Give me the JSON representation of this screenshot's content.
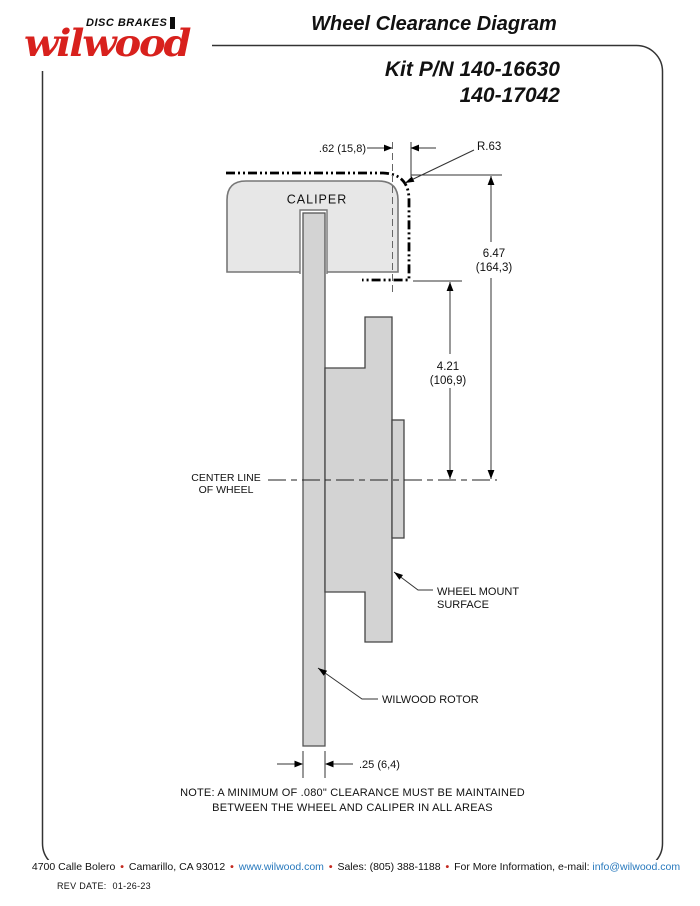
{
  "colors": {
    "brand_red": "#d8211d",
    "link_blue": "#2879bd",
    "caliper_fill": "#e7e7e7",
    "rotor_fill": "#d3d3d3",
    "line_dark": "#333333"
  },
  "logo": {
    "brand": "wilwood",
    "tagline": "DISC BRAKES"
  },
  "header": {
    "title": "Wheel Clearance Diagram",
    "kit_line1": "Kit P/N 140-16630",
    "kit_line2": "140-17042"
  },
  "diagram": {
    "caliper_label": "CALIPER",
    "dim_caliper_overhang": ".62 (15,8)",
    "corner_radius_label": "R.63",
    "dim_caliper_height_in": "6.47",
    "dim_caliper_height_mm": "(164,3)",
    "dim_mount_to_center_in": "4.21",
    "dim_mount_to_center_mm": "(106,9)",
    "centerline_line1": "CENTER LINE",
    "centerline_line2": "OF WHEEL",
    "wheel_mount_line1": "WHEEL MOUNT",
    "wheel_mount_line2": "SURFACE",
    "rotor_label": "WILWOOD ROTOR",
    "dim_rotor_width": ".25 (6,4)"
  },
  "note": {
    "line1": "NOTE: A MINIMUM OF .080\" CLEARANCE MUST BE MAINTAINED",
    "line2": "BETWEEN THE WHEEL AND CALIPER IN ALL AREAS"
  },
  "footer": {
    "address": "4700 Calle Bolero",
    "city": "Camarillo, CA 93012",
    "website": "www.wilwood.com",
    "sales": "Sales: (805) 388-1188",
    "info_label": "For More Information, e-mail:",
    "email": "info@wilwood.com",
    "separator": "•"
  },
  "revision": {
    "label": "REV DATE:",
    "date": "01-26-23"
  }
}
